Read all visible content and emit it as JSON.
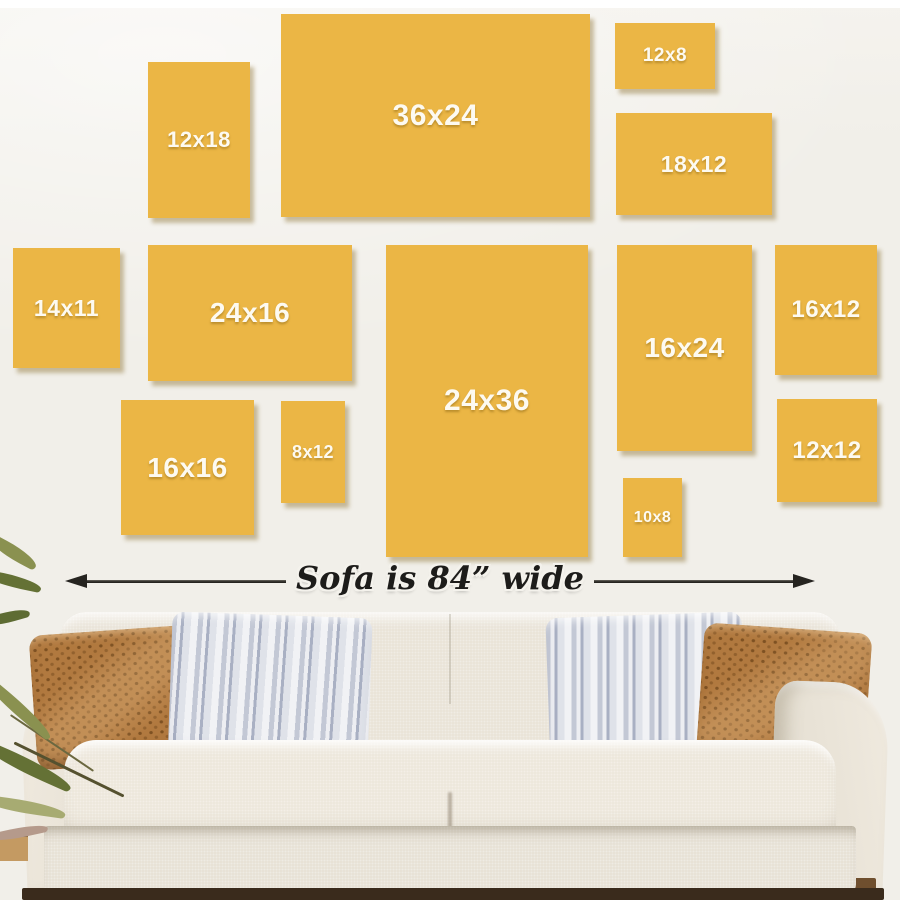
{
  "size_boxes": [
    {
      "label": "12x18",
      "x": 148,
      "y": 62,
      "w": 102,
      "h": 156,
      "font_px": 22
    },
    {
      "label": "36x24",
      "x": 281,
      "y": 14,
      "w": 309,
      "h": 203,
      "font_px": 30
    },
    {
      "label": "12x8",
      "x": 615,
      "y": 23,
      "w": 100,
      "h": 66,
      "font_px": 19
    },
    {
      "label": "18x12",
      "x": 616,
      "y": 113,
      "w": 156,
      "h": 102,
      "font_px": 23
    },
    {
      "label": "14x11",
      "x": 13,
      "y": 248,
      "w": 107,
      "h": 120,
      "font_px": 23
    },
    {
      "label": "24x16",
      "x": 148,
      "y": 245,
      "w": 204,
      "h": 136,
      "font_px": 28
    },
    {
      "label": "24x36",
      "x": 386,
      "y": 245,
      "w": 202,
      "h": 312,
      "font_px": 30
    },
    {
      "label": "16x24",
      "x": 617,
      "y": 245,
      "w": 135,
      "h": 206,
      "font_px": 28
    },
    {
      "label": "16x12",
      "x": 775,
      "y": 245,
      "w": 102,
      "h": 130,
      "font_px": 24
    },
    {
      "label": "16x16",
      "x": 121,
      "y": 400,
      "w": 133,
      "h": 135,
      "font_px": 28
    },
    {
      "label": "8x12",
      "x": 281,
      "y": 401,
      "w": 64,
      "h": 102,
      "font_px": 18
    },
    {
      "label": "10x8",
      "x": 623,
      "y": 478,
      "w": 59,
      "h": 79,
      "font_px": 16
    },
    {
      "label": "12x12",
      "x": 777,
      "y": 399,
      "w": 100,
      "h": 103,
      "font_px": 24
    }
  ],
  "arrow": {
    "label": "Sofa is 84” wide"
  },
  "colors": {
    "canvas": "#ebb645",
    "canvas_shadow": "rgba(130,100,30,0.4)",
    "wall": "#f1efe9",
    "white_strip": "#ffffff",
    "label": "#fdfaf1",
    "arrow": "#262420",
    "sofa_light": "#ece6da",
    "sofa_mid": "#e8e2d6",
    "sofa_dark": "#e6e0d4",
    "pillow_rust": "#b1793f",
    "pillow_rust_dot": "#7e5122",
    "stripe_a": "#c3c8d5",
    "stripe_b": "#edeef2",
    "stripe_c": "#a9b0c3",
    "floor_dark": "#3a2b1c",
    "floor_tan": "#c49a62",
    "leaf_a": "#8a9150",
    "leaf_b": "#647135",
    "leaf_c": "#a7ab72"
  }
}
